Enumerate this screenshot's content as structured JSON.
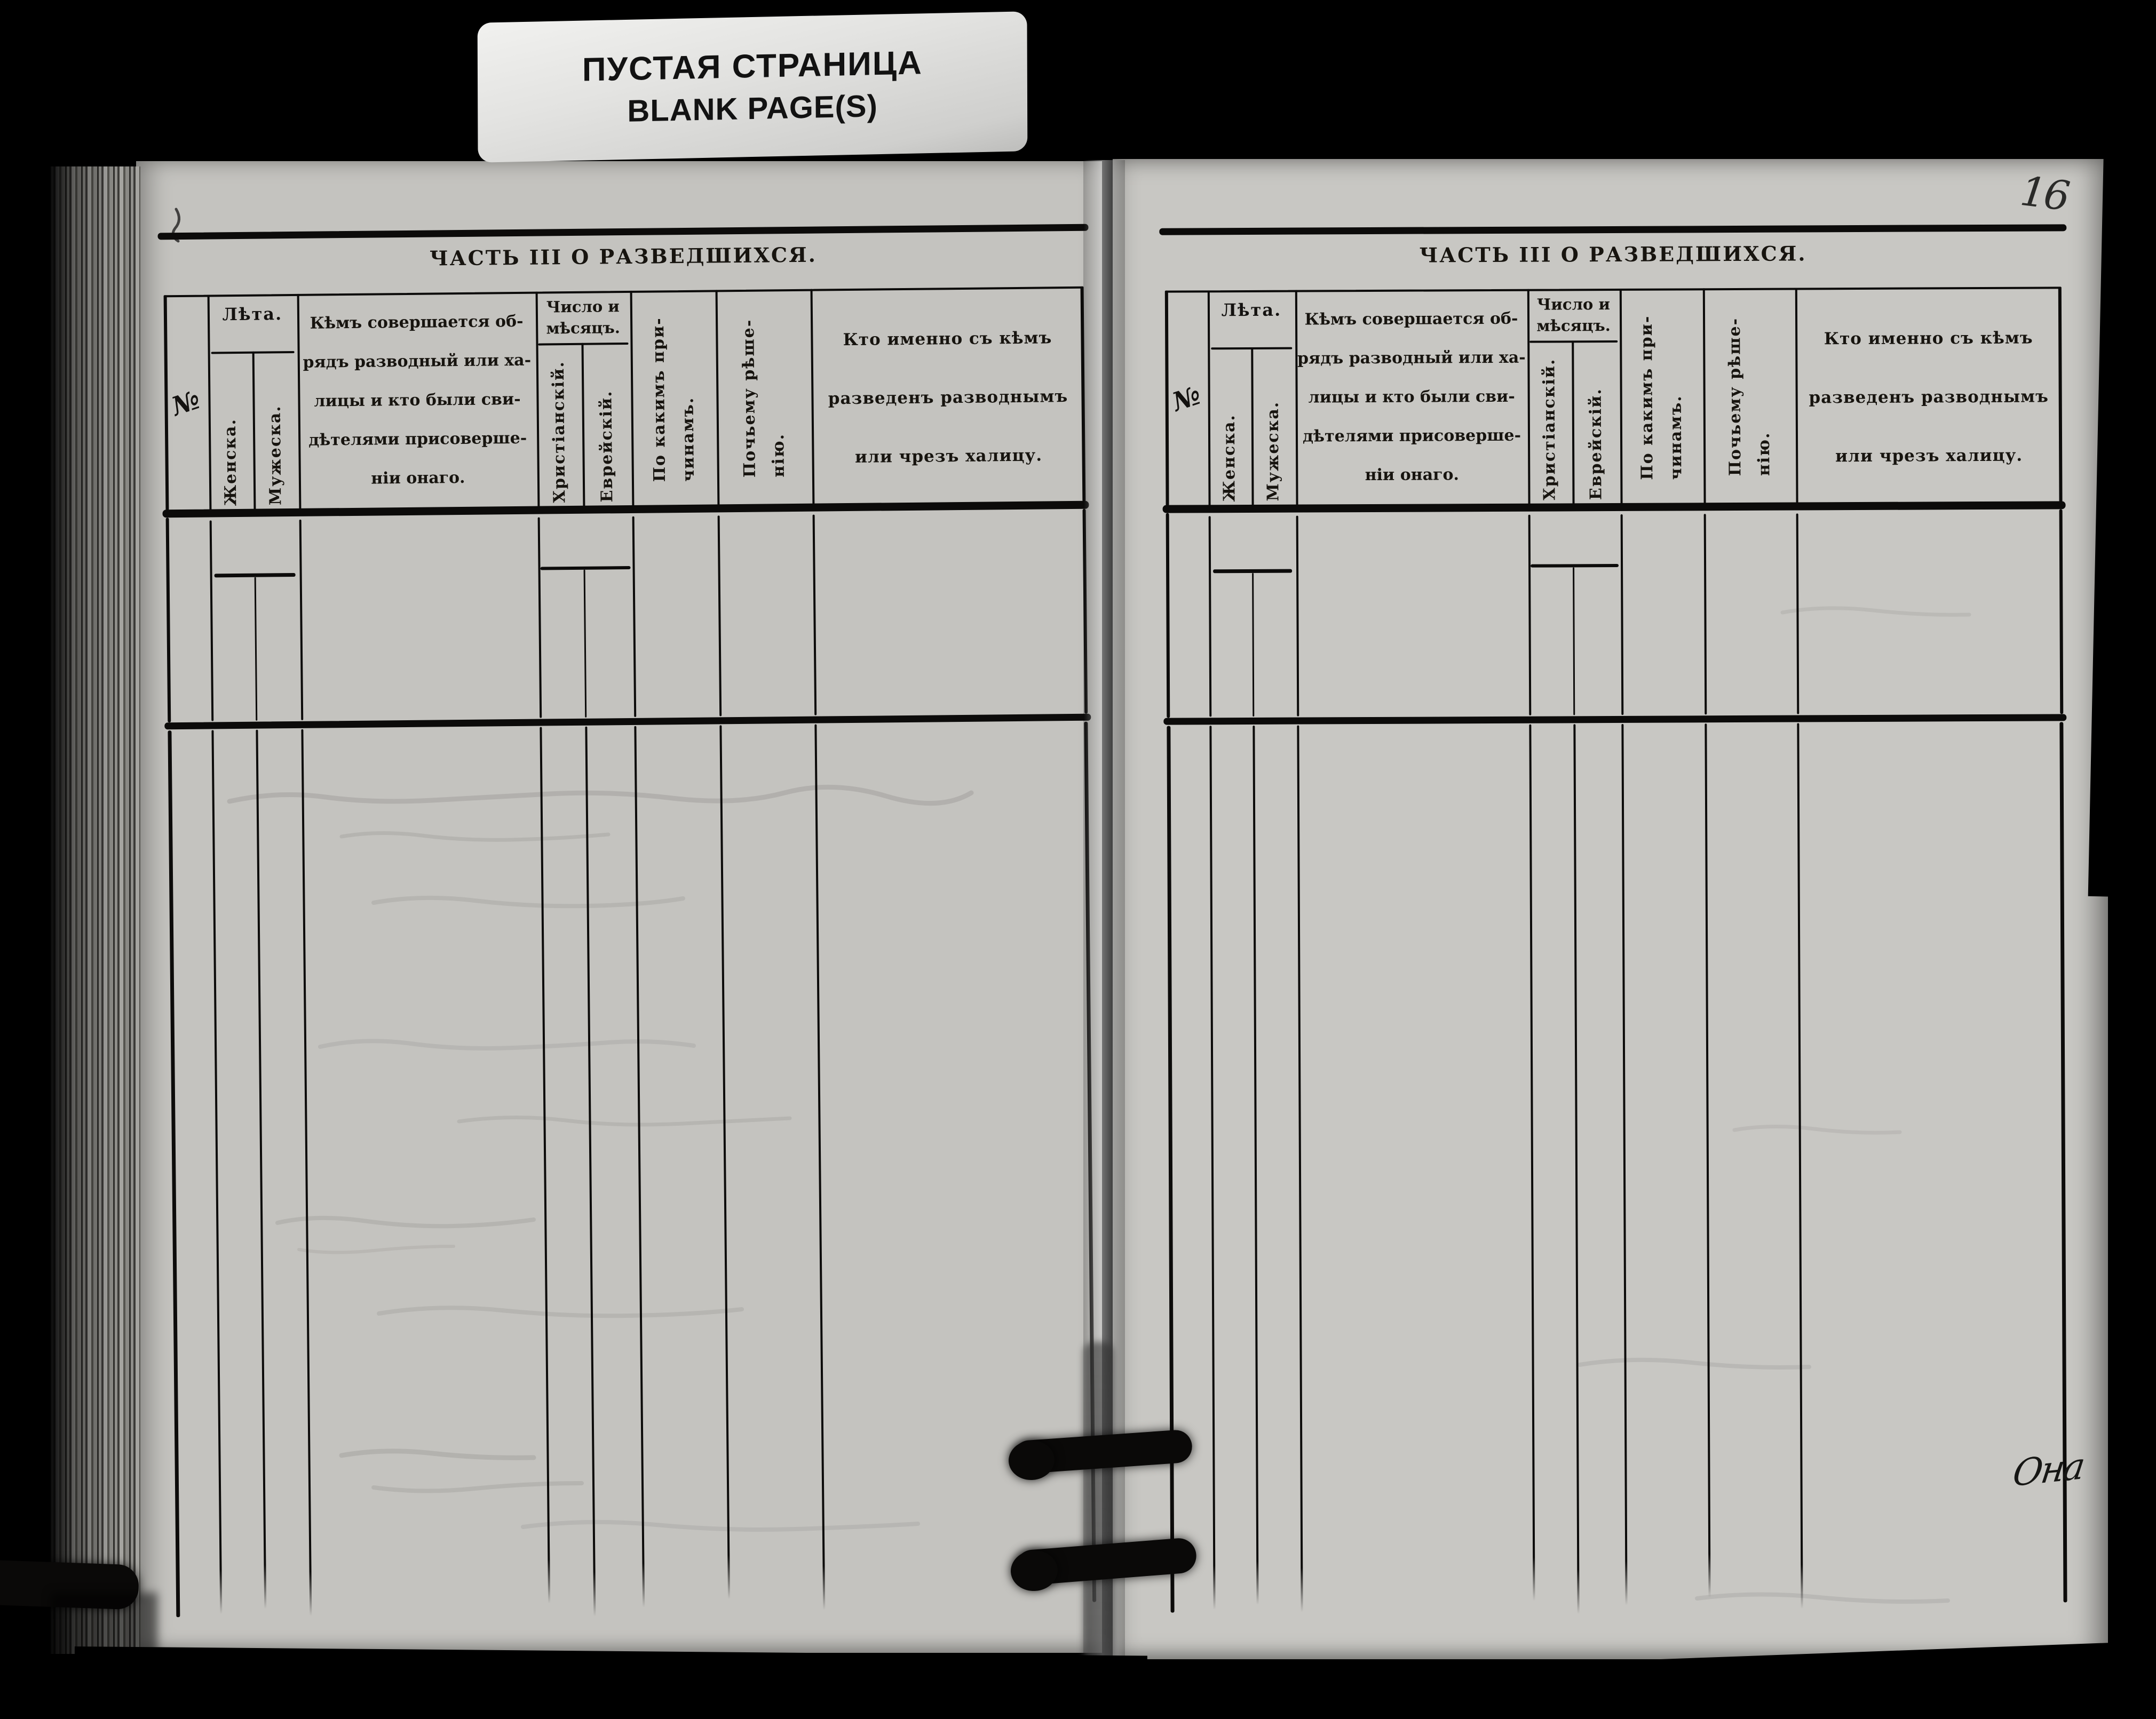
{
  "banner": {
    "line1": "ПУСТАЯ СТРАНИЦА",
    "line2": "BLANK PAGE(S)"
  },
  "annotations": {
    "page_number": "16",
    "handwritten_scribble": "Она"
  },
  "table": {
    "title": "ЧАСТЬ III О РАЗВЕДШИХСЯ.",
    "groups": {
      "leta": "Лѣта.",
      "chislo": [
        "Число и",
        "мѣсяцъ."
      ]
    },
    "columns": [
      {
        "id": "num",
        "label": "№",
        "type": "mark"
      },
      {
        "id": "zhenska",
        "label": "Женска.",
        "type": "vertical",
        "group": "leta"
      },
      {
        "id": "muzheska",
        "label": "Мужеска.",
        "type": "vertical",
        "group": "leta"
      },
      {
        "id": "kem-sovershaetsya",
        "type": "block",
        "lines": [
          "Кѣмъ  совершается  об-",
          "рядъ  разводный или ха-",
          "лицы  и  кто  были  сви-",
          "дѣтелями   присоверше-",
          "ніи онаго."
        ]
      },
      {
        "id": "khristianskiy",
        "label": "Христіанскій.",
        "type": "vertical",
        "group": "chislo"
      },
      {
        "id": "evreyskiy",
        "label": "Еврейскій.",
        "type": "vertical",
        "group": "chislo"
      },
      {
        "id": "po-kakim-prichinam",
        "type": "vertical-multi",
        "lines": [
          "По какимъ при-",
          "чинамъ."
        ]
      },
      {
        "id": "pochemu-resheniyu",
        "type": "vertical-multi",
        "lines": [
          "Почьему рѣше-",
          "нію."
        ]
      },
      {
        "id": "kto-imenno",
        "type": "block",
        "lines": [
          "Кто именно съ кѣмъ",
          "разведенъ разводнымъ",
          "или чрезъ халицу."
        ]
      }
    ]
  },
  "pages": [
    {
      "side": "left"
    },
    {
      "side": "right"
    }
  ],
  "colors": {
    "background": "#000000",
    "paper_left": "#c4c3bf",
    "paper_right": "#c8c7c3",
    "card": "#e8e8e6",
    "ink": "#141210",
    "rule": "#0c0b0a"
  }
}
